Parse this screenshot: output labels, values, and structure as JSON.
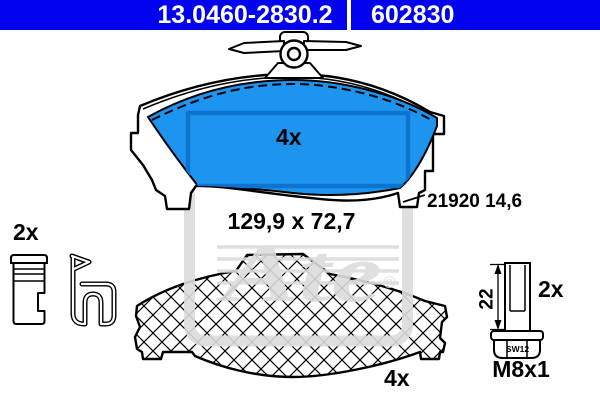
{
  "header": {
    "part_number": "13.0460-2830.2",
    "article_number": "602830",
    "background_color": "#0202EE",
    "text_color": "#FFFFFF"
  },
  "pad_back_view": {
    "quantity": "4x",
    "dimensions": "129,9 x 72,7",
    "wva_thickness": "21920 14,6",
    "friction_color": "#1D94F0",
    "friction_inner_line_color": "#0C74CE"
  },
  "accessory_clips": {
    "quantity": "2x"
  },
  "pad_front_view": {
    "quantity": "4x"
  },
  "guide_bolt": {
    "quantity": "2x",
    "shank_length": "22",
    "thread": "M8x1",
    "wrench_size": "SW12"
  },
  "watermark": {
    "brand_script": "Ate",
    "registered_mark": "®",
    "color": "#DCDCDC"
  }
}
